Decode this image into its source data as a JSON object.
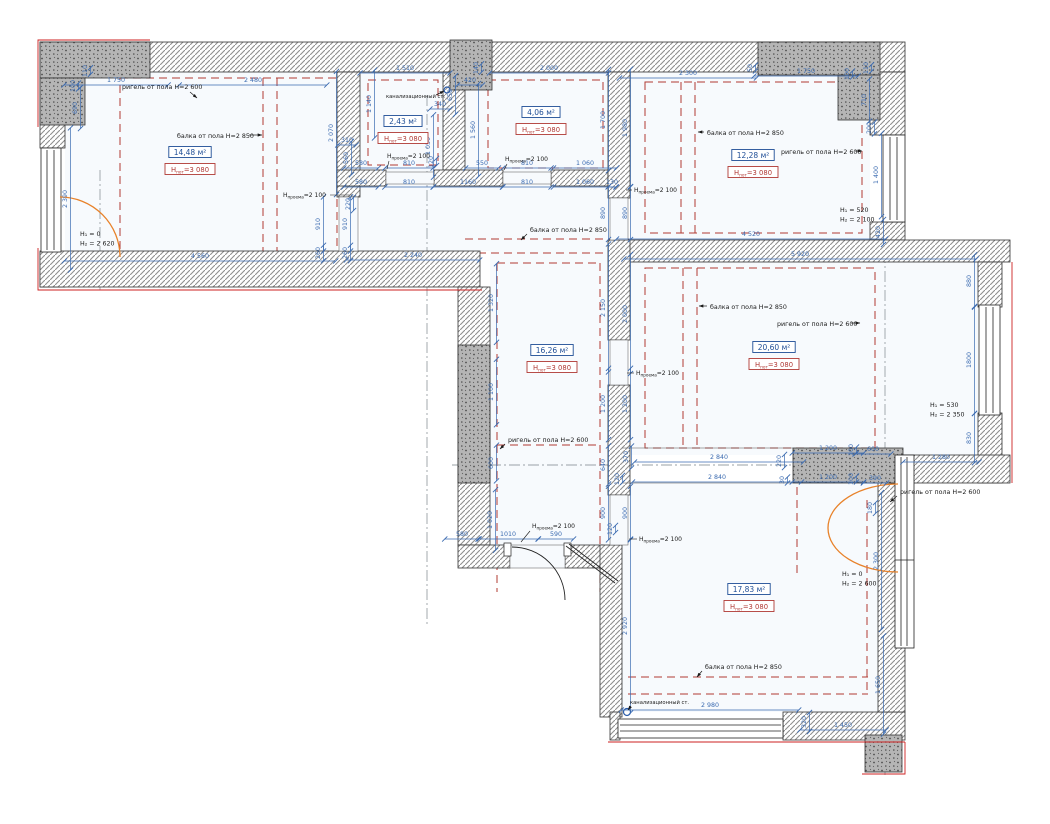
{
  "drawing": {
    "type": "floor-plan",
    "units": "mm",
    "colors": {
      "dimension": "#3a6ab0",
      "area_box": "#1f4e96",
      "ceiling_box": "#b03a36",
      "beam_dash": "#b23b32",
      "door_swing": "#e8822a",
      "axis": "#9aa0a6",
      "annotation": "#1a1a1a",
      "accent_red": "#cc2222",
      "room_fill": "#f7fafd"
    },
    "ceiling_label": {
      "pre": "Н",
      "sub": "пот",
      "post": "=3 080"
    },
    "opening_label": {
      "pre": "Н",
      "sub": "проема",
      "post": "=2 100"
    },
    "rooms": [
      {
        "area": "14,48 м²",
        "x": 190,
        "y": 155
      },
      {
        "area": "2,43 м²",
        "x": 403,
        "y": 124
      },
      {
        "area": "4,06 м²",
        "x": 541,
        "y": 115
      },
      {
        "area": "12,28 м²",
        "x": 753,
        "y": 158
      },
      {
        "area": "16,26 м²",
        "x": 552,
        "y": 353
      },
      {
        "area": "20,60 м²",
        "x": 774,
        "y": 350
      },
      {
        "area": "17,83 м²",
        "x": 749,
        "y": 592
      }
    ],
    "dims": [
      {
        "t": "1 750",
        "x": 116,
        "y": 82,
        "o": "h"
      },
      {
        "t": "2 480",
        "x": 253,
        "y": 82,
        "o": "h"
      },
      {
        "t": "1 510",
        "x": 405,
        "y": 70,
        "o": "h"
      },
      {
        "t": "140",
        "x": 478,
        "y": 68,
        "o": "v"
      },
      {
        "t": "420",
        "x": 470,
        "y": 82,
        "o": "h"
      },
      {
        "t": "650",
        "x": 452,
        "y": 95,
        "o": "v"
      },
      {
        "t": "340",
        "x": 440,
        "y": 106,
        "o": "h"
      },
      {
        "t": "2 000",
        "x": 549,
        "y": 70,
        "o": "h"
      },
      {
        "t": "2 300",
        "x": 688,
        "y": 75,
        "o": "h"
      },
      {
        "t": "50",
        "x": 752,
        "y": 68,
        "o": "v"
      },
      {
        "t": "1 750",
        "x": 806,
        "y": 73,
        "o": "h"
      },
      {
        "t": "100",
        "x": 849,
        "y": 74,
        "o": "v"
      },
      {
        "t": "110",
        "x": 868,
        "y": 68,
        "o": "v"
      },
      {
        "t": "710",
        "x": 866,
        "y": 100,
        "o": "v"
      },
      {
        "t": "200",
        "x": 871,
        "y": 128,
        "o": "v"
      },
      {
        "t": "1 400",
        "x": 878,
        "y": 175,
        "o": "v"
      },
      {
        "t": "420",
        "x": 880,
        "y": 232,
        "o": "v"
      },
      {
        "t": "110",
        "x": 87,
        "y": 71,
        "o": "v"
      },
      {
        "t": "100",
        "x": 75,
        "y": 86,
        "o": "v"
      },
      {
        "t": "690",
        "x": 77,
        "y": 108,
        "o": "v"
      },
      {
        "t": "2 390",
        "x": 67,
        "y": 199,
        "o": "v"
      },
      {
        "t": "4 560",
        "x": 200,
        "y": 258,
        "o": "h"
      },
      {
        "t": "1 140",
        "x": 371,
        "y": 104,
        "o": "v"
      },
      {
        "t": "2 070",
        "x": 333,
        "y": 133,
        "o": "v"
      },
      {
        "t": "310",
        "x": 347,
        "y": 142,
        "o": "h"
      },
      {
        "t": "560",
        "x": 348,
        "y": 158,
        "o": "v"
      },
      {
        "t": "220",
        "x": 350,
        "y": 204,
        "o": "v"
      },
      {
        "t": "910",
        "x": 320,
        "y": 224,
        "o": "v"
      },
      {
        "t": "910",
        "x": 347,
        "y": 224,
        "o": "v"
      },
      {
        "t": "260",
        "x": 320,
        "y": 253,
        "o": "v"
      },
      {
        "t": "260",
        "x": 347,
        "y": 253,
        "o": "v"
      },
      {
        "t": "2 240",
        "x": 413,
        "y": 257,
        "o": "h"
      },
      {
        "t": "580",
        "x": 361,
        "y": 165,
        "o": "h"
      },
      {
        "t": "810",
        "x": 409,
        "y": 165,
        "o": "h"
      },
      {
        "t": "550",
        "x": 482,
        "y": 165,
        "o": "h"
      },
      {
        "t": "810",
        "x": 527,
        "y": 165,
        "o": "h"
      },
      {
        "t": "1 060",
        "x": 585,
        "y": 165,
        "o": "h"
      },
      {
        "t": "580",
        "x": 361,
        "y": 184,
        "o": "h"
      },
      {
        "t": "810",
        "x": 409,
        "y": 184,
        "o": "h"
      },
      {
        "t": "1160",
        "x": 468,
        "y": 184,
        "o": "h"
      },
      {
        "t": "810",
        "x": 527,
        "y": 184,
        "o": "h"
      },
      {
        "t": "1 060",
        "x": 585,
        "y": 184,
        "o": "h"
      },
      {
        "t": "130",
        "x": 612,
        "y": 184,
        "o": "h"
      },
      {
        "t": "1 050",
        "x": 430,
        "y": 146,
        "o": "v"
      },
      {
        "t": "120",
        "x": 433,
        "y": 162,
        "o": "v"
      },
      {
        "t": "1 560",
        "x": 475,
        "y": 130,
        "o": "v"
      },
      {
        "t": "1 700",
        "x": 605,
        "y": 120,
        "o": "v"
      },
      {
        "t": "1 980",
        "x": 627,
        "y": 128,
        "o": "v"
      },
      {
        "t": "890",
        "x": 605,
        "y": 213,
        "o": "v"
      },
      {
        "t": "890",
        "x": 627,
        "y": 213,
        "o": "v"
      },
      {
        "t": "4 520",
        "x": 751,
        "y": 236,
        "o": "h"
      },
      {
        "t": "5 920",
        "x": 800,
        "y": 256,
        "o": "h"
      },
      {
        "t": "1 320",
        "x": 493,
        "y": 303,
        "o": "v"
      },
      {
        "t": "2 150",
        "x": 605,
        "y": 308,
        "o": "v"
      },
      {
        "t": "2 000",
        "x": 627,
        "y": 314,
        "o": "v"
      },
      {
        "t": "1 100",
        "x": 493,
        "y": 392,
        "o": "v"
      },
      {
        "t": "1 200",
        "x": 605,
        "y": 404,
        "o": "v"
      },
      {
        "t": "1 200",
        "x": 627,
        "y": 404,
        "o": "v"
      },
      {
        "t": "600",
        "x": 493,
        "y": 463,
        "o": "v"
      },
      {
        "t": "640",
        "x": 605,
        "y": 465,
        "o": "v"
      },
      {
        "t": "370",
        "x": 628,
        "y": 457,
        "o": "v"
      },
      {
        "t": "120",
        "x": 619,
        "y": 479,
        "o": "v"
      },
      {
        "t": "1 020",
        "x": 492,
        "y": 520,
        "o": "v"
      },
      {
        "t": "900",
        "x": 605,
        "y": 513,
        "o": "v"
      },
      {
        "t": "900",
        "x": 627,
        "y": 513,
        "o": "v"
      },
      {
        "t": "120",
        "x": 612,
        "y": 529,
        "o": "v"
      },
      {
        "t": "580",
        "x": 462,
        "y": 536,
        "o": "h"
      },
      {
        "t": "1010",
        "x": 508,
        "y": 536,
        "o": "h"
      },
      {
        "t": "590",
        "x": 556,
        "y": 536,
        "o": "h"
      },
      {
        "t": "2 840",
        "x": 719,
        "y": 459,
        "o": "h"
      },
      {
        "t": "2 840",
        "x": 717,
        "y": 479,
        "o": "h"
      },
      {
        "t": "220",
        "x": 781,
        "y": 461,
        "o": "v"
      },
      {
        "t": "30",
        "x": 784,
        "y": 480,
        "o": "v"
      },
      {
        "t": "1 200",
        "x": 828,
        "y": 450,
        "o": "h"
      },
      {
        "t": "100",
        "x": 853,
        "y": 450,
        "o": "v"
      },
      {
        "t": "600",
        "x": 873,
        "y": 451,
        "o": "h"
      },
      {
        "t": "1 200",
        "x": 828,
        "y": 479,
        "o": "h"
      },
      {
        "t": "100",
        "x": 853,
        "y": 479,
        "o": "v"
      },
      {
        "t": "390",
        "x": 875,
        "y": 480,
        "o": "h"
      },
      {
        "t": "1 280",
        "x": 941,
        "y": 459,
        "o": "h"
      },
      {
        "t": "880",
        "x": 971,
        "y": 281,
        "o": "v"
      },
      {
        "t": "1800",
        "x": 971,
        "y": 360,
        "o": "v"
      },
      {
        "t": "830",
        "x": 971,
        "y": 438,
        "o": "v"
      },
      {
        "t": "180",
        "x": 872,
        "y": 508,
        "o": "v"
      },
      {
        "t": "2 300",
        "x": 878,
        "y": 561,
        "o": "v"
      },
      {
        "t": "1 650",
        "x": 880,
        "y": 685,
        "o": "v"
      },
      {
        "t": "2 920",
        "x": 627,
        "y": 626,
        "o": "v"
      },
      {
        "t": "2 980",
        "x": 710,
        "y": 707,
        "o": "h"
      },
      {
        "t": "320",
        "x": 806,
        "y": 722,
        "o": "v"
      },
      {
        "t": "1 450",
        "x": 843,
        "y": 727,
        "o": "h"
      }
    ],
    "annotations": [
      {
        "t": "ригель от пола Н=2 600",
        "x": 122,
        "y": 89,
        "leader": [
          190,
          92,
          197,
          98
        ],
        "small": false
      },
      {
        "t": "балка от пола Н=2 850",
        "x": 177,
        "y": 138,
        "leader": [
          249,
          135,
          262,
          135
        ],
        "small": false
      },
      {
        "t": "канализационный ст.",
        "x": 386,
        "y": 98,
        "leader": [
          436,
          95,
          444,
          91
        ],
        "small": true
      },
      {
        "t": "балка от пола Н=2 850",
        "x": 707,
        "y": 135,
        "leader": [
          704,
          132,
          698,
          132
        ],
        "small": false
      },
      {
        "t": "ригель от пола Н=2 600",
        "x": 781,
        "y": 154,
        "leader": [
          855,
          151,
          862,
          151
        ],
        "small": false
      },
      {
        "t": "балка от пола Н=2 850",
        "x": 530,
        "y": 232,
        "leader": [
          527,
          234,
          521,
          240
        ],
        "small": false
      },
      {
        "t": "балка от пола Н=2 850",
        "x": 710,
        "y": 309,
        "leader": [
          707,
          306,
          699,
          306
        ],
        "small": false
      },
      {
        "t": "ригель от пола Н=2 600",
        "x": 777,
        "y": 326,
        "leader": [
          851,
          323,
          860,
          323
        ],
        "small": false
      },
      {
        "t": "ригель от пола Н=2 600",
        "x": 508,
        "y": 442,
        "leader": [
          505,
          444,
          500,
          449
        ],
        "small": false
      },
      {
        "t": "ригель от пола Н=2 600",
        "x": 900,
        "y": 494,
        "leader": [
          897,
          496,
          890,
          502
        ],
        "small": false
      },
      {
        "t": "балка от пола Н=2 850",
        "x": 705,
        "y": 669,
        "leader": [
          702,
          671,
          697,
          677
        ],
        "small": false
      },
      {
        "t": "канализационный ст.",
        "x": 630,
        "y": 704,
        "leader": [
          631,
          706,
          628,
          710
        ],
        "small": true
      }
    ],
    "opening_heights": [
      {
        "x": 283,
        "y": 197,
        "leader": [
          330,
          195,
          352,
          195
        ]
      },
      {
        "x": 387,
        "y": 158,
        "leader": [
          389,
          161,
          387,
          169
        ]
      },
      {
        "x": 505,
        "y": 161,
        "leader": [
          507,
          164,
          504,
          170
        ]
      },
      {
        "x": 634,
        "y": 192,
        "leader": [
          632,
          190,
          626,
          190
        ]
      },
      {
        "x": 636,
        "y": 375,
        "leader": [
          634,
          373,
          627,
          373
        ]
      },
      {
        "x": 532,
        "y": 528,
        "leader": [
          530,
          531,
          521,
          542
        ]
      },
      {
        "x": 639,
        "y": 541,
        "leader": [
          637,
          539,
          629,
          539
        ]
      }
    ],
    "sill_heights": [
      {
        "l1": "Н₁ = 0",
        "l2": "Н₂ = 2 620",
        "x": 80,
        "y": 236
      },
      {
        "l1": "Н₁ = 520",
        "l2": "Н₂ = 2 100",
        "x": 840,
        "y": 212
      },
      {
        "l1": "Н₁ = 530",
        "l2": "Н₂ = 2 350",
        "x": 930,
        "y": 407
      },
      {
        "l1": "Н₁ = 0",
        "l2": "Н₂ = 2 600",
        "x": 842,
        "y": 576
      }
    ]
  }
}
